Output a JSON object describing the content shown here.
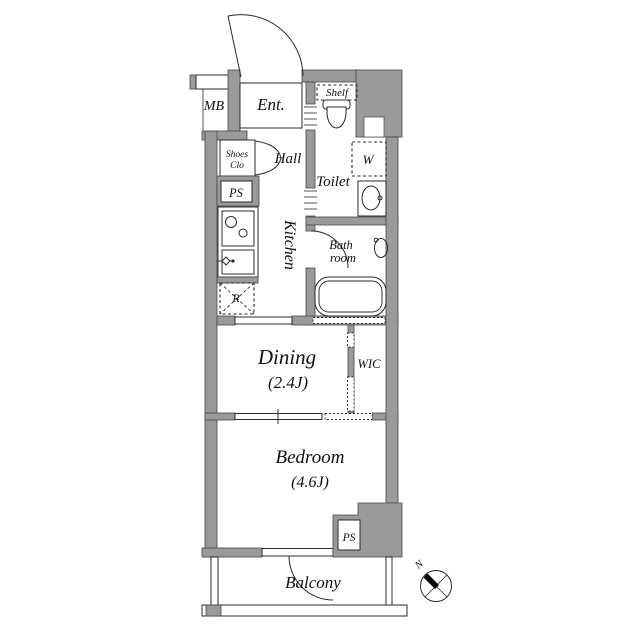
{
  "document": {
    "type": "apartment-floor-plan"
  },
  "colors": {
    "wall": "#9a9a9a",
    "outline": "#474747",
    "line": "#2b2b2b",
    "text": "#111111",
    "bg": "#ffffff"
  },
  "labels": {
    "mb": "MB",
    "ent": "Ent.",
    "shelf": "Shelf",
    "shoes_line1": "Shoes",
    "shoes_line2": "Clo",
    "hall": "Hall",
    "ps_upper": "PS",
    "toilet": "Toilet",
    "washer": "W",
    "kitchen": "Kitchen",
    "bath_line1": "Bath",
    "bath_line2": "room",
    "fridge": "R",
    "dining": "Dining",
    "dining_area": "(2.4J)",
    "wic": "WIC",
    "bedroom": "Bedroom",
    "bedroom_area": "(4.6J)",
    "ps_lower": "PS",
    "balcony": "Balcony",
    "north": "N"
  },
  "rooms": [
    {
      "name": "Entrance",
      "label": "Ent."
    },
    {
      "name": "Hall",
      "label": "Hall"
    },
    {
      "name": "Kitchen",
      "label": "Kitchen"
    },
    {
      "name": "Toilet",
      "label": "Toilet"
    },
    {
      "name": "Bath room",
      "label": "Bath room"
    },
    {
      "name": "Dining",
      "label": "Dining",
      "area": "(2.4J)"
    },
    {
      "name": "WIC",
      "label": "WIC"
    },
    {
      "name": "Bedroom",
      "label": "Bedroom",
      "area": "(4.6J)"
    },
    {
      "name": "Balcony",
      "label": "Balcony"
    }
  ]
}
